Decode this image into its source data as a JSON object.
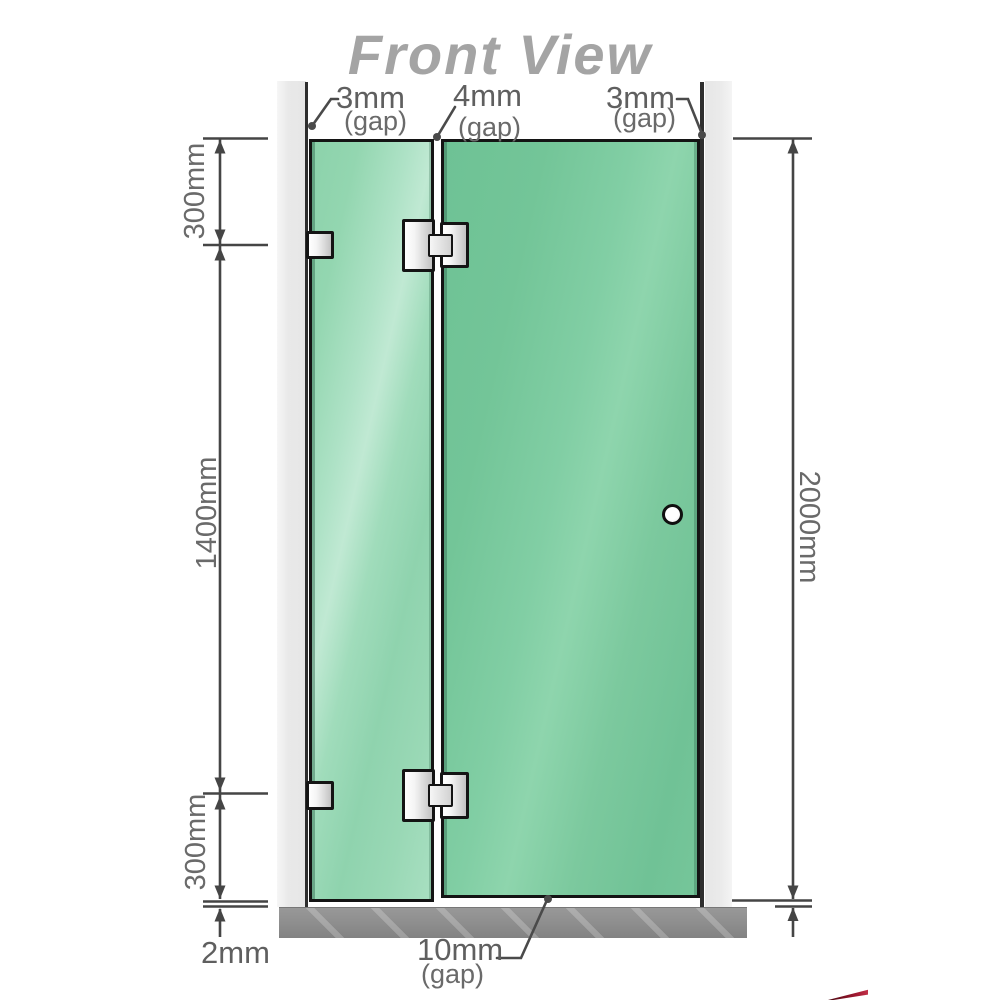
{
  "title": "Front View",
  "top_gaps": [
    {
      "value": "3mm",
      "suffix": "(gap)"
    },
    {
      "value": "4mm",
      "suffix": "(gap)"
    },
    {
      "value": "3mm",
      "suffix": "(gap)"
    }
  ],
  "dims": {
    "left_top": "300mm",
    "left_middle": "1400mm",
    "left_bottom": "300mm",
    "right_total": "2000mm",
    "floor_gap": "2mm"
  },
  "bottom_gap": {
    "value": "10mm",
    "suffix": "(gap)"
  },
  "colors": {
    "glass_left": "#9bd8b8",
    "glass_right": "#74c79a",
    "wall": "#e9e9e9",
    "floor": "#8f8f8f",
    "panel_border": "#141414",
    "dimension_line": "#454545",
    "label_text": "#5f5f5f",
    "title_text": "#a4a4a4",
    "accent_red": "#a01830"
  }
}
